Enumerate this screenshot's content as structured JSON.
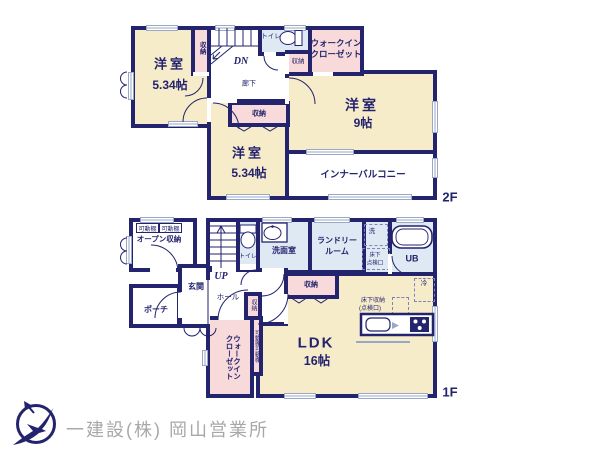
{
  "palette": {
    "wall_navy": "#23236e",
    "room_cream": "#f7ecca",
    "closet_pink": "#f8dada",
    "wet_area_blue": "#dfe9f3",
    "window_line": "#9aa8c8",
    "logo_gray": "#a8a8a8"
  },
  "f2": {
    "floor_tag": "2F",
    "bedroom_left": {
      "name": "洋室",
      "size": "5.34帖"
    },
    "closet_strip": "収納",
    "stairs": "DN",
    "toilet": "トイレ",
    "wic": {
      "line1": "ウォークイン",
      "line2": "クローゼット"
    },
    "closet_small": "収納",
    "hallway": "廊下",
    "closet_bottom": "収納",
    "bedroom_right": {
      "name": "洋室",
      "size": "9帖"
    },
    "bedroom_center": {
      "name": "洋室",
      "size": "5.34帖"
    },
    "balcony": "インナーバルコニー"
  },
  "f1": {
    "floor_tag": "1F",
    "shelf_tag_1": "可動棚",
    "shelf_tag_2": "可動棚",
    "open_storage": "オープン収納",
    "entrance": "玄関",
    "porch": "ポーチ",
    "stairs": "UP",
    "toilet": "トイレ",
    "washroom": "洗面室",
    "laundry": {
      "line1": "ランドリー",
      "line2": "ルーム"
    },
    "washer": "洗",
    "underfloor_hatch": {
      "line1": "床下",
      "line2": "点検口"
    },
    "bath": "UB",
    "hall": "ホール",
    "closet_center": "収納",
    "fridge": "冷",
    "closet_small": "収納",
    "shelf_strip": "可動棚可動棚",
    "wic": {
      "line1": "ウォークイン",
      "line2": "クローゼット"
    },
    "underfloor_storage": {
      "line1": "床下収納",
      "line2": "(点検口)"
    },
    "ldk": {
      "name": "LDK",
      "size": "16帖"
    }
  },
  "footer": {
    "company": "一建設(株) 岡山営業所"
  }
}
